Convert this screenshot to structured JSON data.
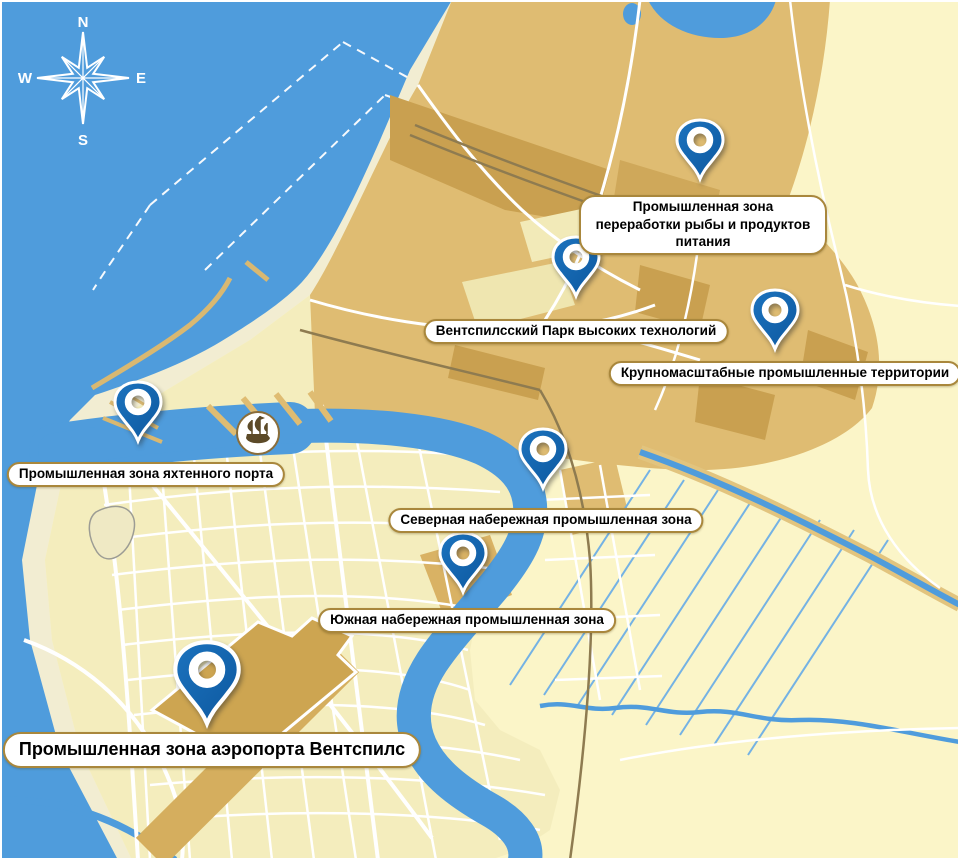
{
  "map": {
    "compass": {
      "north": "N",
      "east": "E",
      "south": "S",
      "west": "W"
    },
    "colors": {
      "sea": "#4F9CDC",
      "land": "#FBF5C8",
      "beach": "#F2EDD2",
      "industrial_zone": "#DFBC72",
      "industrial_dark": "#C9A050",
      "city": "#F4EDBD",
      "pin_blue": "#1465AC",
      "label_border": "#A9873C",
      "road": "#FFFFFF"
    },
    "icons": {
      "compass_rose": "8-point star with N/E/S/W letters",
      "ship_emblem": "sailing ship in white circle",
      "pin": "blue teardrop marker with ring hole"
    },
    "markers": [
      {
        "id": "fish-processing-zone",
        "label": "Промышленная зона переработки рыбы и продуктов питания"
      },
      {
        "id": "high-tech-park",
        "label": "Вентспилсский Парк высоких технологий"
      },
      {
        "id": "large-scale-territories",
        "label": "Крупномасштабные промышленные территории"
      },
      {
        "id": "yacht-port-zone",
        "label": "Промышленная зона яхтенного порта"
      },
      {
        "id": "north-embankment-zone",
        "label": "Северная набережная промышленная зона"
      },
      {
        "id": "south-embankment-zone",
        "label": "Южная набережная промышленная зона"
      },
      {
        "id": "airport-zone",
        "label": "Промышленная зона аэропорта Вентспилс"
      }
    ]
  }
}
